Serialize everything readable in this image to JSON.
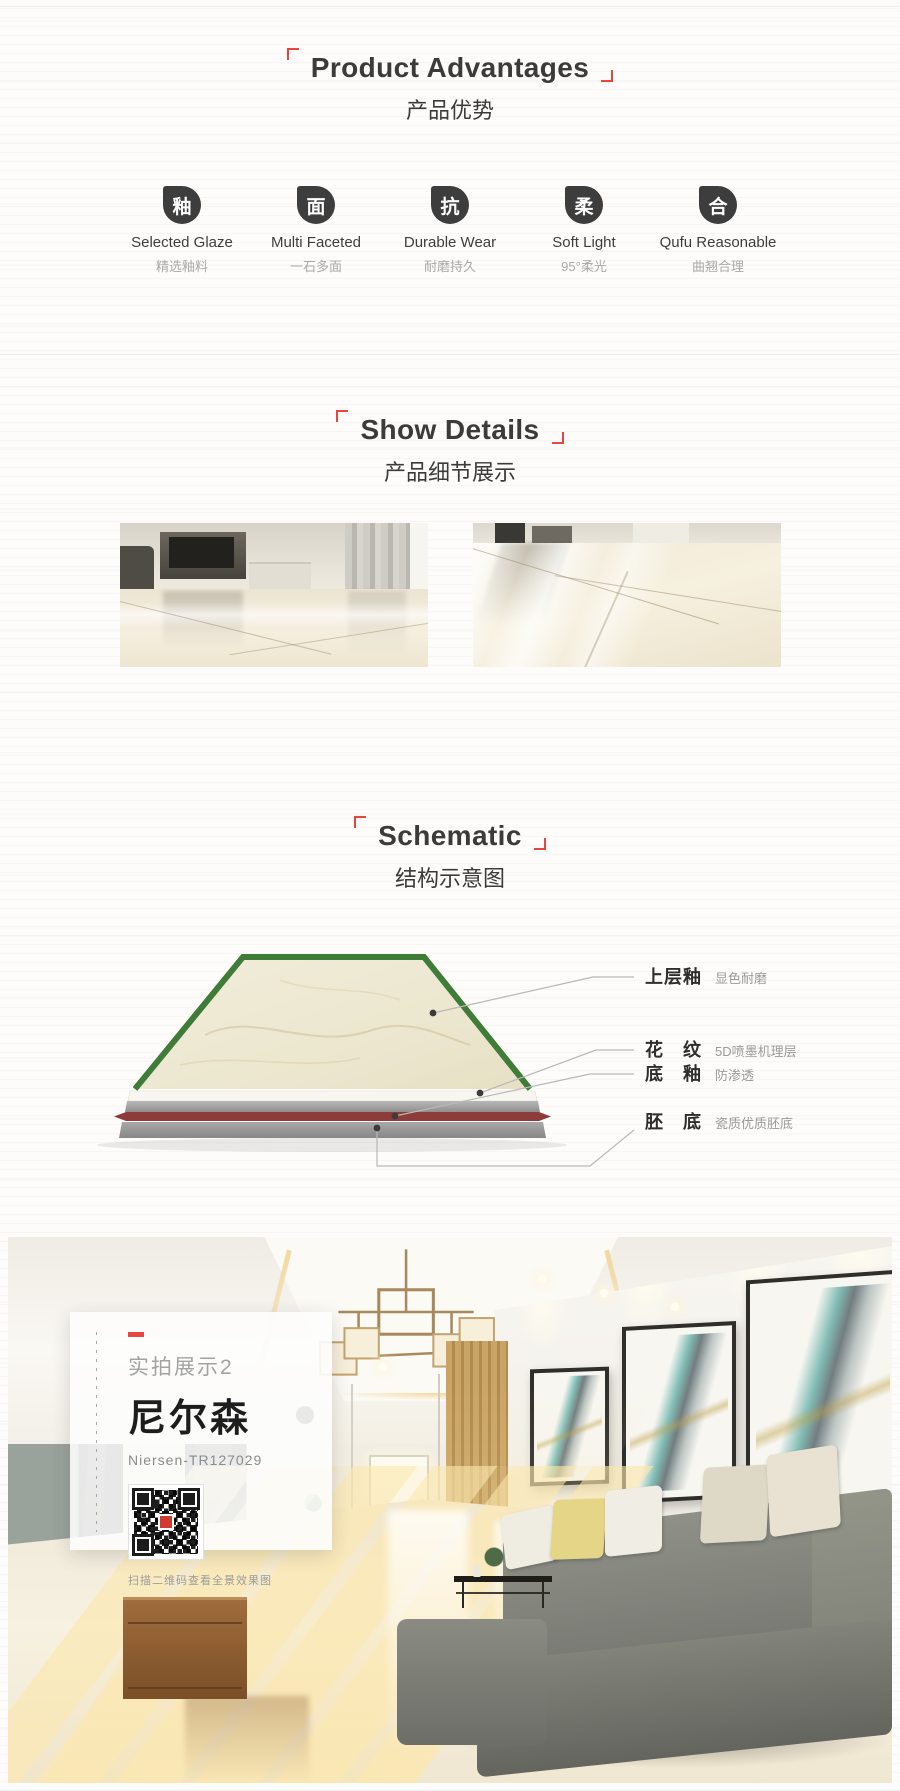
{
  "colors": {
    "accent_red": "#e8453e",
    "icon_bg": "#3d3d3d",
    "schematic_green": "#3e7c38",
    "schematic_body_red": "#8e3c39"
  },
  "section_product_advantages": {
    "title_en": "Product Advantages",
    "title_zh": "产品优势",
    "features": [
      {
        "icon_name": "glaze-drop-icon",
        "icon_char": "釉",
        "en": "Selected Glaze",
        "zh": "精选釉料"
      },
      {
        "icon_name": "facet-drop-icon",
        "icon_char": "面",
        "en": "Multi Faceted",
        "zh": "一石多面"
      },
      {
        "icon_name": "wear-drop-icon",
        "icon_char": "抗",
        "en": "Durable Wear",
        "zh": "耐磨持久"
      },
      {
        "icon_name": "soft-drop-icon",
        "icon_char": "柔",
        "en": "Soft Light",
        "zh": "95°柔光"
      },
      {
        "icon_name": "flat-drop-icon",
        "icon_char": "合",
        "en": "Qufu Reasonable",
        "zh": "曲翘合理"
      }
    ]
  },
  "section_show_details": {
    "title_en": "Show Details",
    "title_zh": "产品细节展示",
    "photos": [
      {
        "alt": "living-room-tile-floor-detail"
      },
      {
        "alt": "glossy-tile-floor-reflection-detail"
      }
    ]
  },
  "section_schematic": {
    "title_en": "Schematic",
    "title_zh": "结构示意图",
    "layers": [
      {
        "name": "上层釉",
        "desc": "显色耐磨"
      },
      {
        "name": "花　纹",
        "desc": "5D喷墨机理层"
      },
      {
        "name": "底　釉",
        "desc": "防渗透"
      },
      {
        "name": "胚　底",
        "desc": "瓷质优质胚底"
      }
    ]
  },
  "section_photo": {
    "tag": "实拍展示2",
    "product_name": "尼尔森",
    "model": "Niersen-TR127029",
    "qr_caption": "扫描二维码查看全景效果图"
  }
}
